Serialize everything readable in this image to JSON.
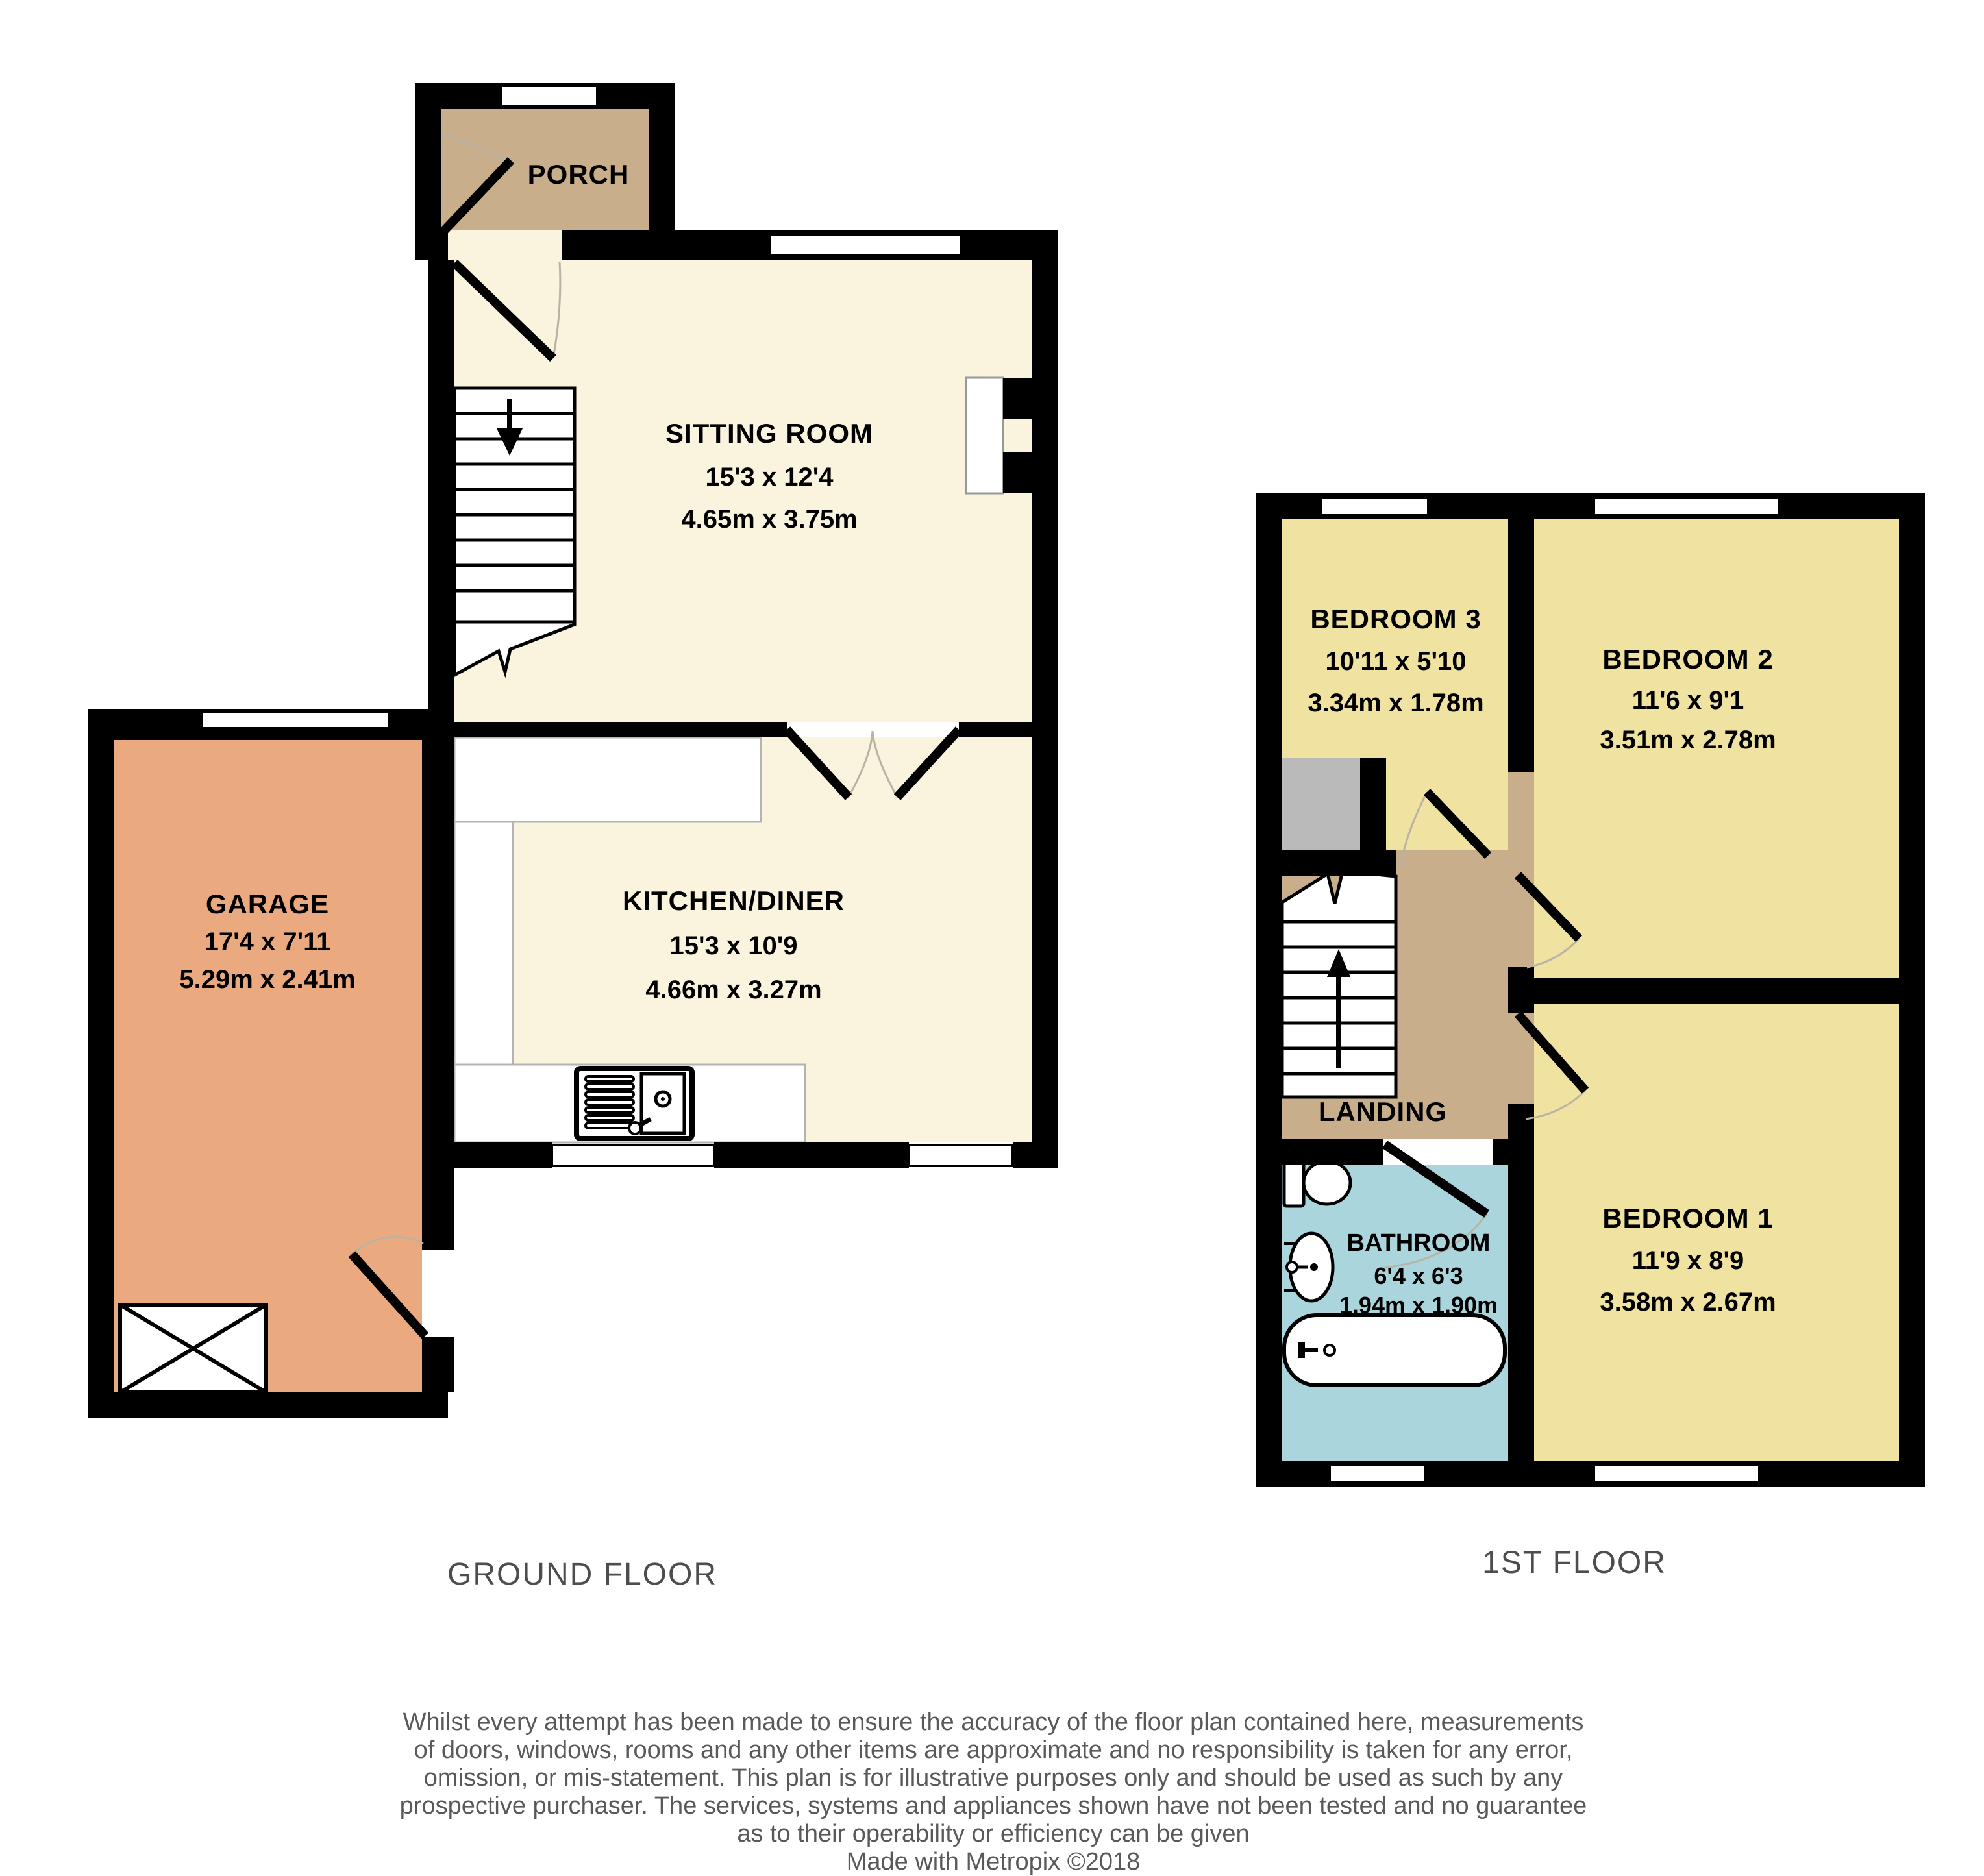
{
  "colors": {
    "cream": "#FAF3DD",
    "tan": "#C9AE8C",
    "garage": "#EAA97E",
    "bedroom": "#F0E3A2",
    "bathroom": "#ABD5DC",
    "gray_box": "#BABABA",
    "wall": "#000000",
    "floor_label": "#4D4D4D",
    "footer_text": "#595959"
  },
  "ground_floor": {
    "label": "GROUND FLOOR",
    "rooms": {
      "porch": {
        "name": "PORCH"
      },
      "sitting_room": {
        "name": "SITTING ROOM",
        "imperial": "15'3 x 12'4",
        "metric": "4.65m x 3.75m"
      },
      "kitchen_diner": {
        "name": "KITCHEN/DINER",
        "imperial": "15'3 x 10'9",
        "metric": "4.66m x 3.27m"
      },
      "garage": {
        "name": "GARAGE",
        "imperial": "17'4 x 7'11",
        "metric": "5.29m x 2.41m"
      }
    }
  },
  "first_floor": {
    "label": "1ST FLOOR",
    "rooms": {
      "bedroom3": {
        "name": "BEDROOM 3",
        "imperial": "10'11 x 5'10",
        "metric": "3.34m x 1.78m"
      },
      "bedroom2": {
        "name": "BEDROOM 2",
        "imperial": "11'6 x 9'1",
        "metric": "3.51m x 2.78m"
      },
      "bedroom1": {
        "name": "BEDROOM 1",
        "imperial": "11'9 x 8'9",
        "metric": "3.58m x 2.67m"
      },
      "bathroom": {
        "name": "BATHROOM",
        "imperial": "6'4 x 6'3",
        "metric": "1.94m x 1.90m"
      },
      "landing": {
        "name": "LANDING"
      }
    }
  },
  "footer": {
    "disclaimer_lines": [
      "Whilst every attempt has been made to ensure the accuracy of the floor plan contained here, measurements",
      "of doors, windows, rooms and any other items are approximate and no responsibility is taken for any error,",
      "omission, or mis-statement. This plan is for illustrative purposes only and should be used as such by any",
      "prospective purchaser. The services, systems and appliances shown have not been tested and no guarantee",
      "as to their operability or efficiency can be given"
    ],
    "credit": "Made with Metropix ©2018"
  }
}
